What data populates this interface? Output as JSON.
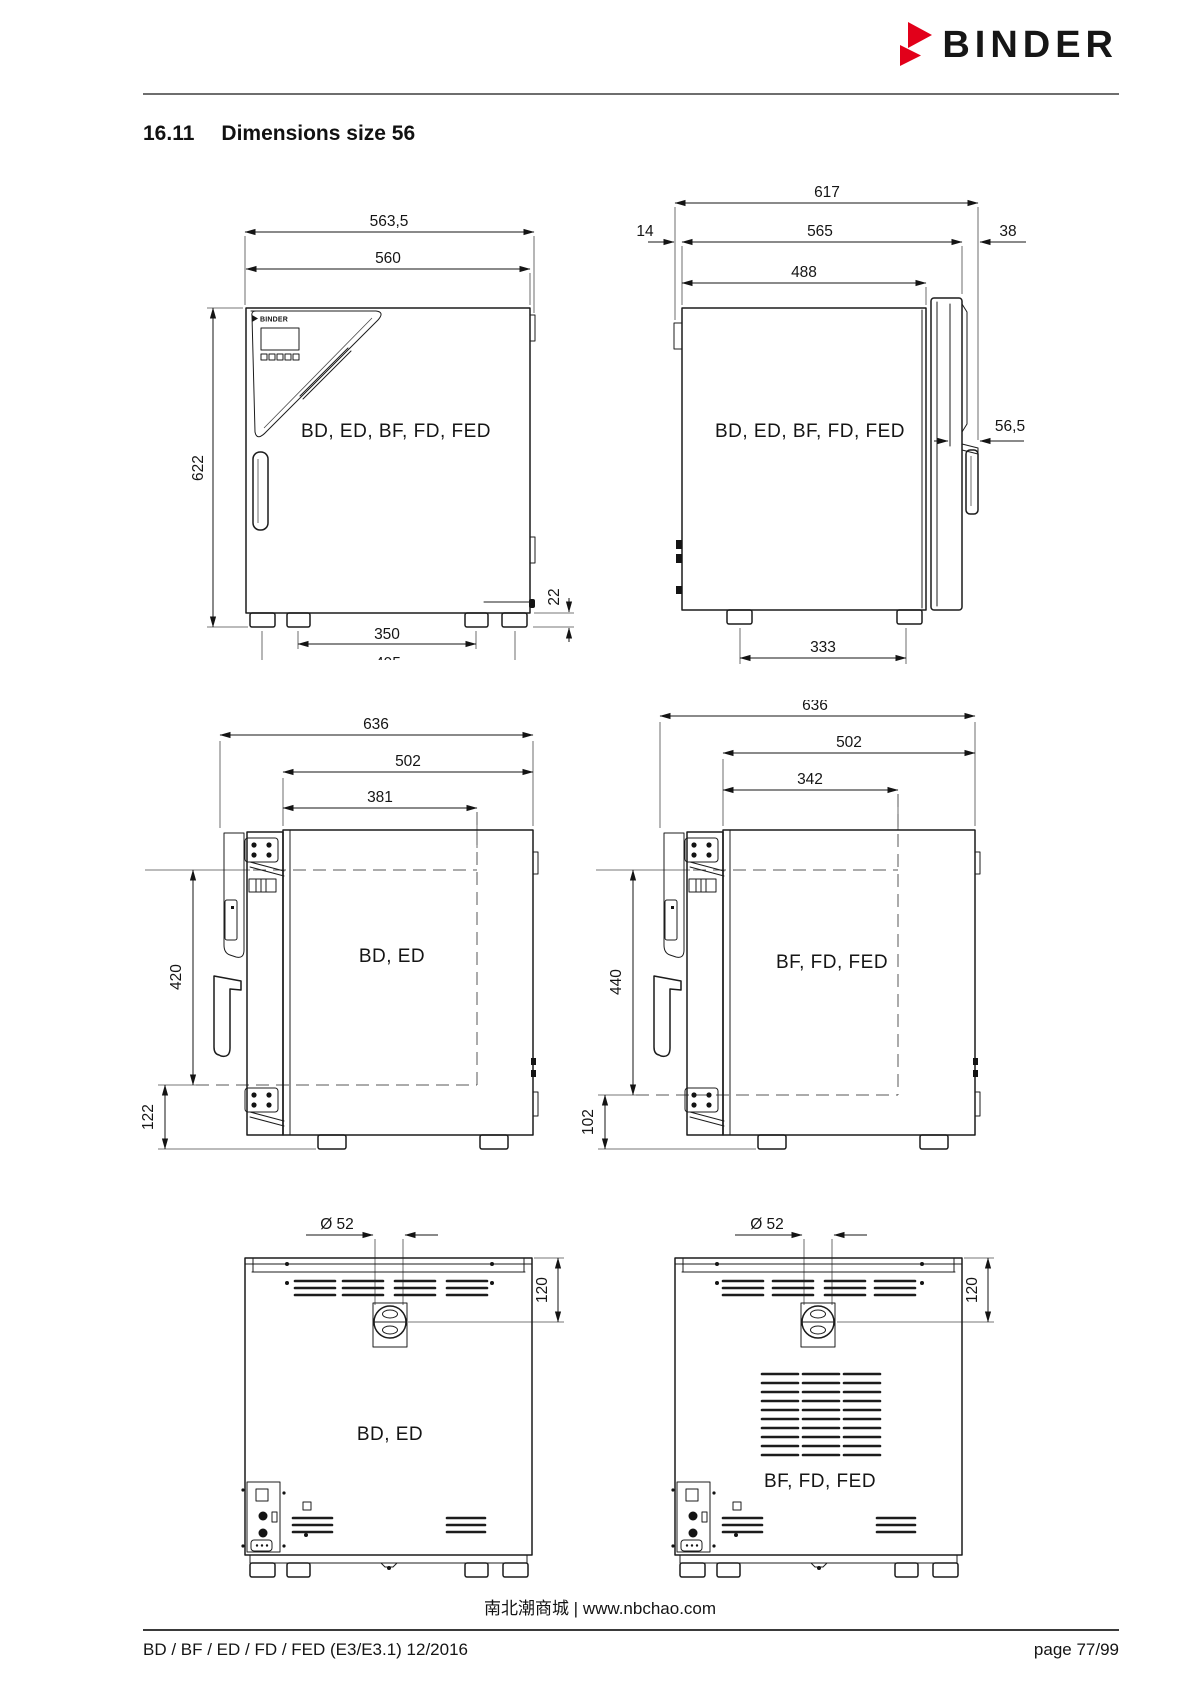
{
  "page": {
    "brand": "BINDER",
    "section_number": "16.11",
    "section_title": "Dimensions size 56",
    "footer_center": "南北潮商城 | www.nbchao.com",
    "footer_left": "BD / BF / ED / FD / FED (E3/E3.1) 12/2016",
    "footer_right": "page 77/99"
  },
  "colors": {
    "accent_red": "#e2001a",
    "ink": "#1a1a1a"
  },
  "drawings": {
    "front_view": {
      "model_label": "BD, ED, BF, FD, FED",
      "panel_logo": "BINDER",
      "dim_total_width": "563,5",
      "dim_housing_width": "560",
      "dim_height": "622",
      "dim_feet_inner": "350",
      "dim_feet_outer": "495",
      "dim_base_height": "22"
    },
    "side_view": {
      "model_label": "BD, ED, BF, FD, FED",
      "dim_total_depth": "617",
      "dim_rear_offset": "14",
      "dim_housing_depth": "565",
      "dim_door_offset": "38",
      "dim_inner_depth": "488",
      "dim_handle_depth": "56,5",
      "dim_feet_spacing": "333"
    },
    "door_open_bd": {
      "model_label": "BD, ED",
      "dim_total_depth": "636",
      "dim_depth_1": "502",
      "dim_depth_2": "381",
      "dim_height_1": "420",
      "dim_height_2": "122"
    },
    "door_open_bf": {
      "model_label": "BF, FD, FED",
      "dim_total_depth": "636",
      "dim_depth_1": "502",
      "dim_depth_2": "342",
      "dim_height_1": "440",
      "dim_height_2": "102"
    },
    "rear_view_bd": {
      "model_label": "BD, ED",
      "dim_port_diameter": "Ø 52",
      "dim_port_offset": "120"
    },
    "rear_view_bf": {
      "model_label": "BF, FD, FED",
      "dim_port_diameter": "Ø 52",
      "dim_port_offset": "120"
    }
  }
}
